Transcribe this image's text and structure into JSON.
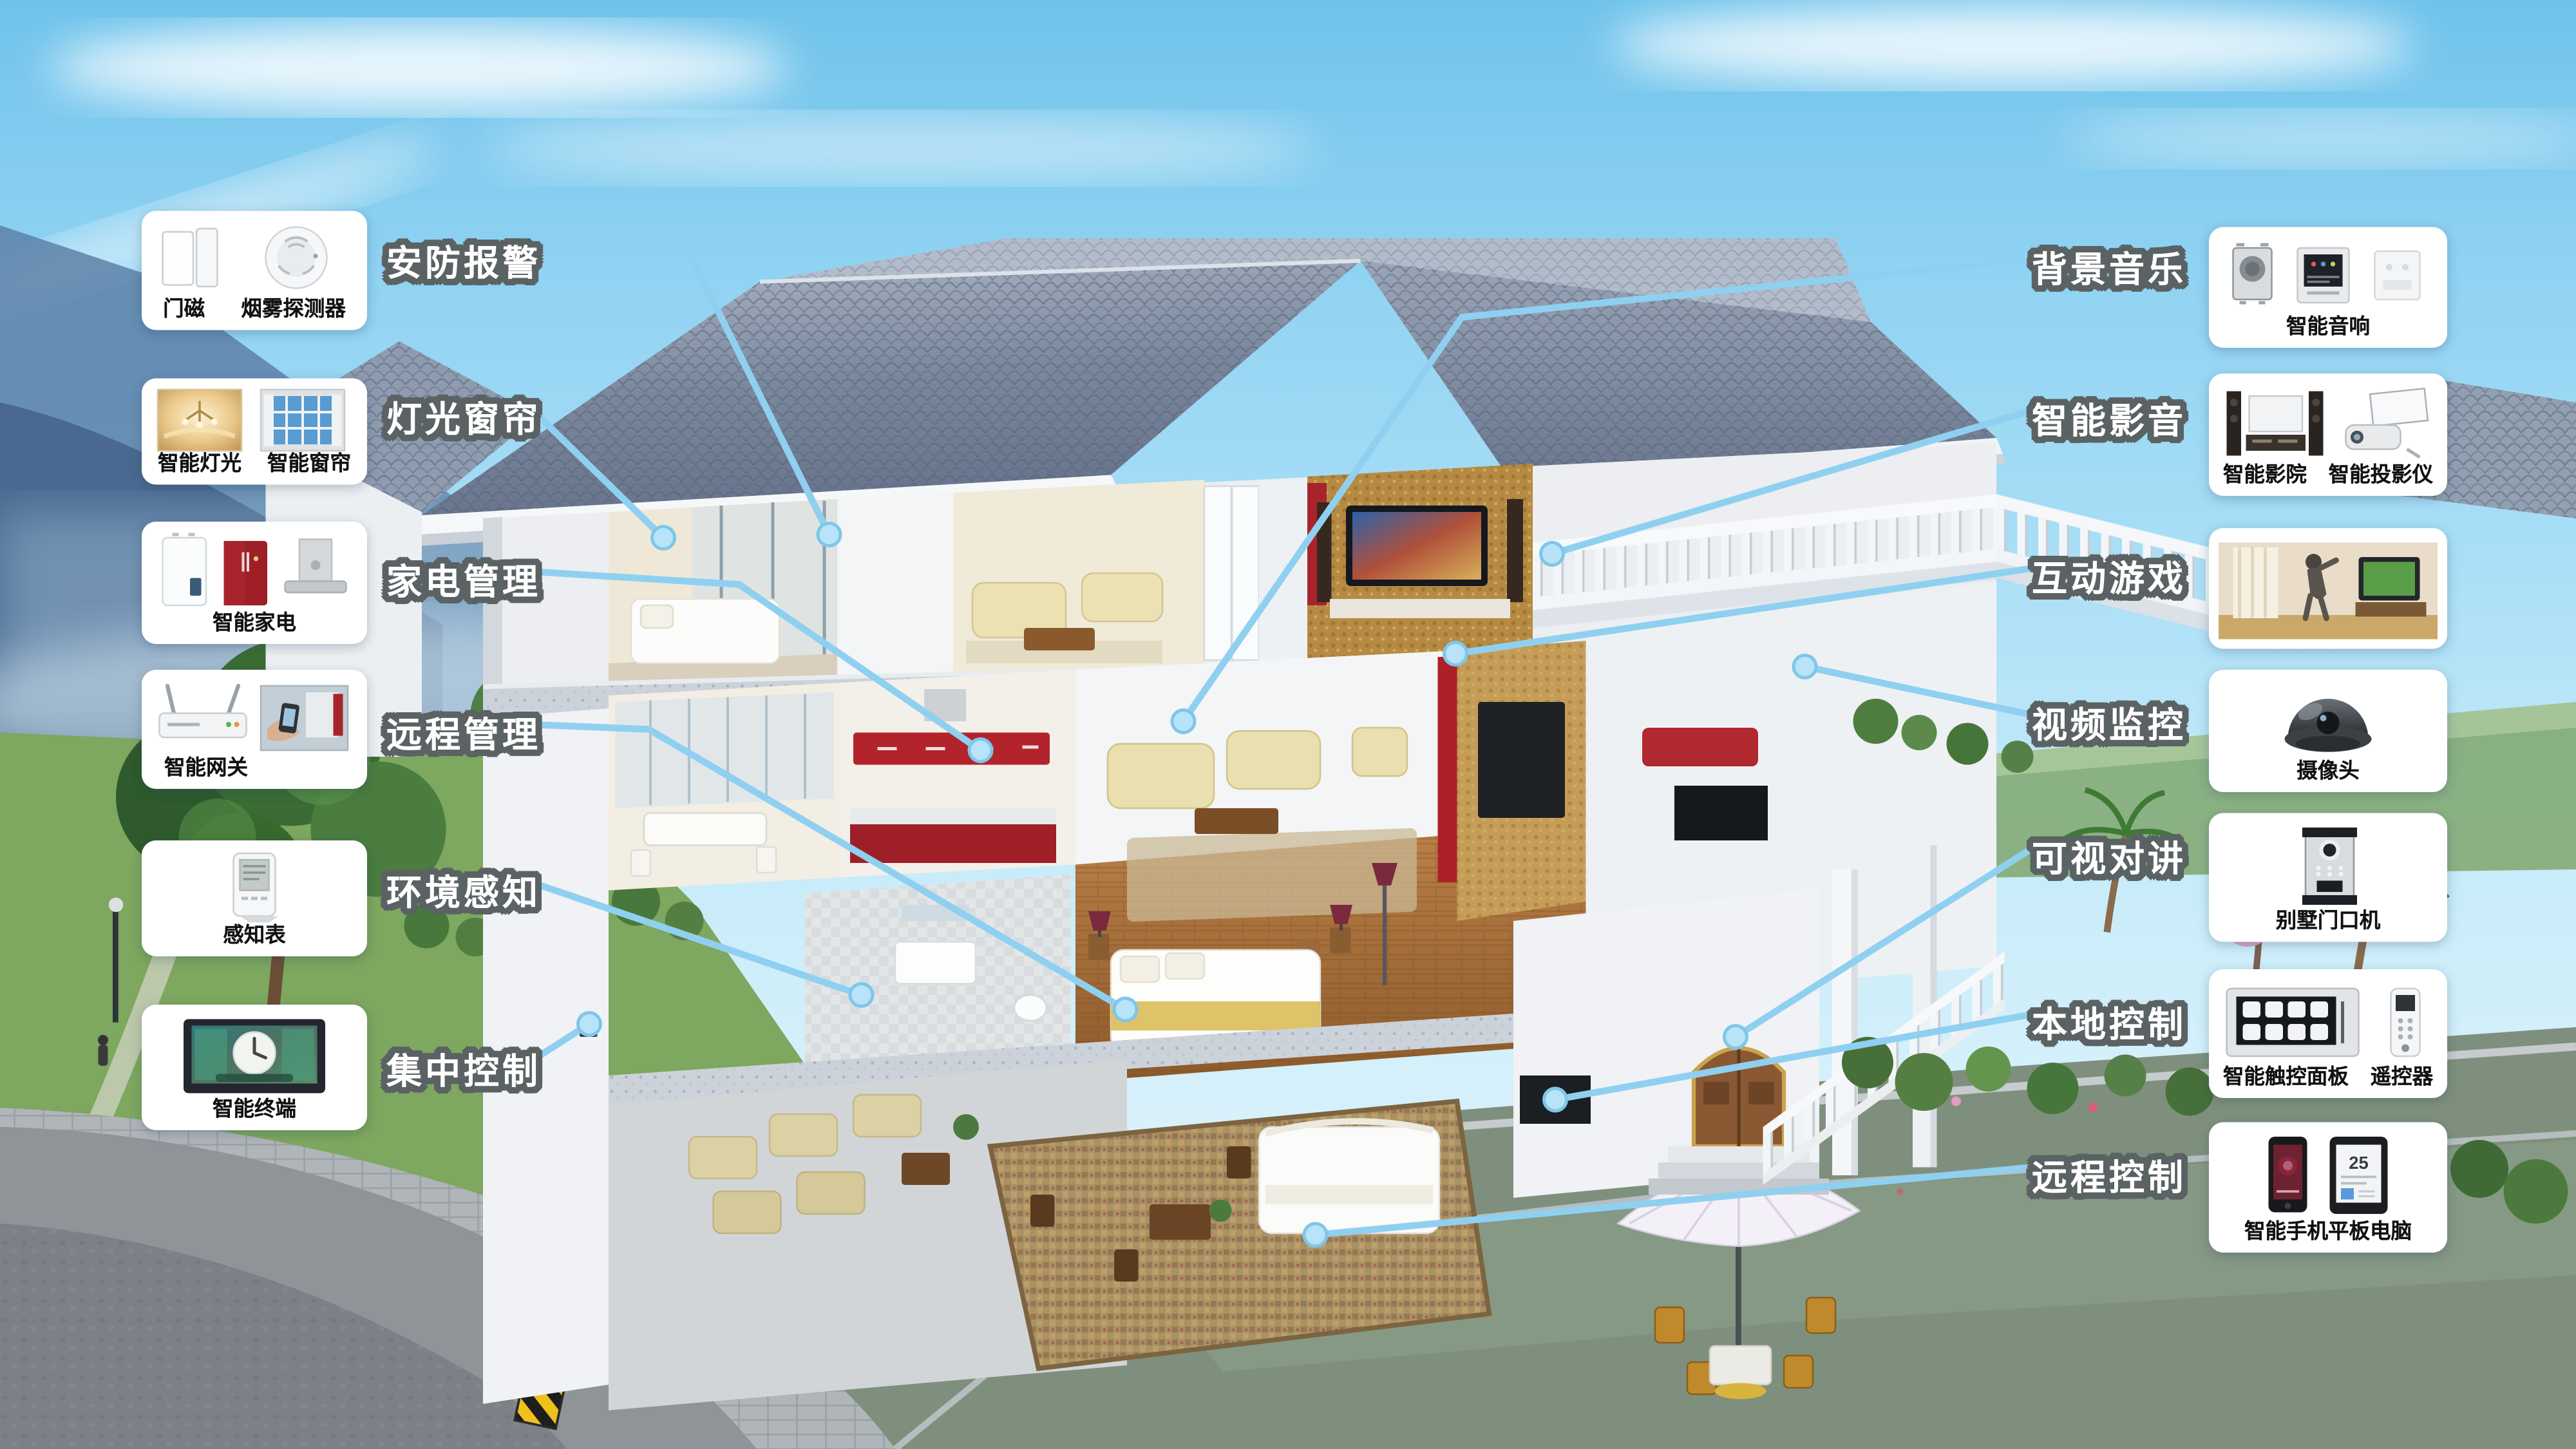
{
  "colors": {
    "leader_line": "#8fd0f1",
    "leader_dot": "#b8e3f8",
    "label_text": "#ffffff",
    "label_outline": "#5a6264",
    "card_background": "#ffffff",
    "caption_text": "#111111",
    "sky": "#7fcdef",
    "roof": "#8a96a9"
  },
  "left_callouts": [
    {
      "label": "安防报警",
      "devices": [
        "门磁",
        "烟雾探测器"
      ]
    },
    {
      "label": "灯光窗帘",
      "devices": [
        "智能灯光",
        "智能窗帘"
      ]
    },
    {
      "label": "家电管理",
      "devices": [
        "智能家电"
      ]
    },
    {
      "label": "远程管理",
      "devices": [
        "智能网关"
      ]
    },
    {
      "label": "环境感知",
      "devices": [
        "感知表"
      ]
    },
    {
      "label": "集中控制",
      "devices": [
        "智能终端"
      ]
    }
  ],
  "right_callouts": [
    {
      "label": "背景音乐",
      "devices": [
        "智能音响"
      ]
    },
    {
      "label": "智能影音",
      "devices": [
        "智能影院",
        "智能投影仪"
      ]
    },
    {
      "label": "互动游戏",
      "devices": []
    },
    {
      "label": "视频监控",
      "devices": [
        "摄像头"
      ]
    },
    {
      "label": "可视对讲",
      "devices": [
        "别墅门口机"
      ]
    },
    {
      "label": "本地控制",
      "devices": [
        "智能触控面板",
        "遥控器"
      ]
    },
    {
      "label": "远程控制",
      "devices": [
        "智能手机平板电脑"
      ],
      "tablet_text": "25"
    }
  ]
}
